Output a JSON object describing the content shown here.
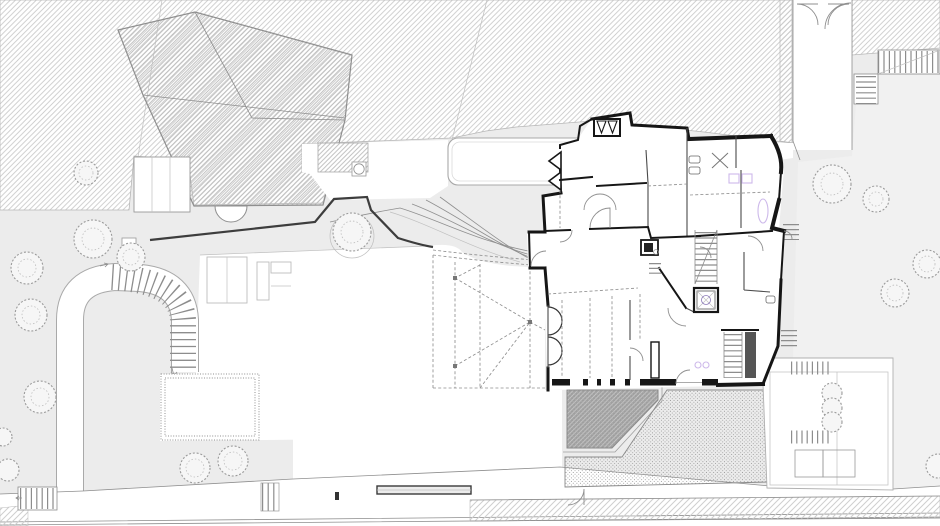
{
  "document": {
    "type": "architectural-site-plan",
    "view": "ground-floor plan with surrounding site",
    "visible_text": "none"
  },
  "palette": {
    "paper": "#ffffff",
    "hatch_line": "#c9c9c9",
    "hatch_line_dense": "#bdbdbd",
    "ground_gray": "#ececec",
    "garden_gray": "#f1f1f1",
    "wall_black": "#161616",
    "partition": "#4a4a4a",
    "fine_line": "#8f8f8f",
    "retaining_wall": "#3d3d3d",
    "fixture_purple": "#cdb9ea",
    "terrace_dark": "#9f9f9f",
    "stipple_dot": "#8e8e8e",
    "tree_line": "#9a9a9a",
    "sidewalk_hatch": "#cfcfcf"
  },
  "features": {
    "site_plan": "architectural site plan, ground floor",
    "neighbor_mass": "adjoining neighbour buildings (diagonal hatch)",
    "neighbor_house": "neighbour house footprint with hip roof",
    "main_house": "main house ground-floor plan with thick cut walls",
    "courtyard": "entrance court and driveway",
    "curved_stair": "curved external stair and ramp loop",
    "pergola": "dashed canopy / pergola structure at west entrance",
    "dark_terrace": "dark cross-hatched terrace",
    "paved_terrace": "stippled paved terrace",
    "rear_terrace": "south-east garden terrace with planters",
    "garden_right": "east garden lawn",
    "garden_left": "west garden strip",
    "street": "street with kerb lines and hatched sidewalk",
    "bench": "long bench at street edge",
    "trees": "garden trees and shrubs",
    "exterior_stairs": "external stair flights",
    "passage": "side passage with double entrance door"
  }
}
